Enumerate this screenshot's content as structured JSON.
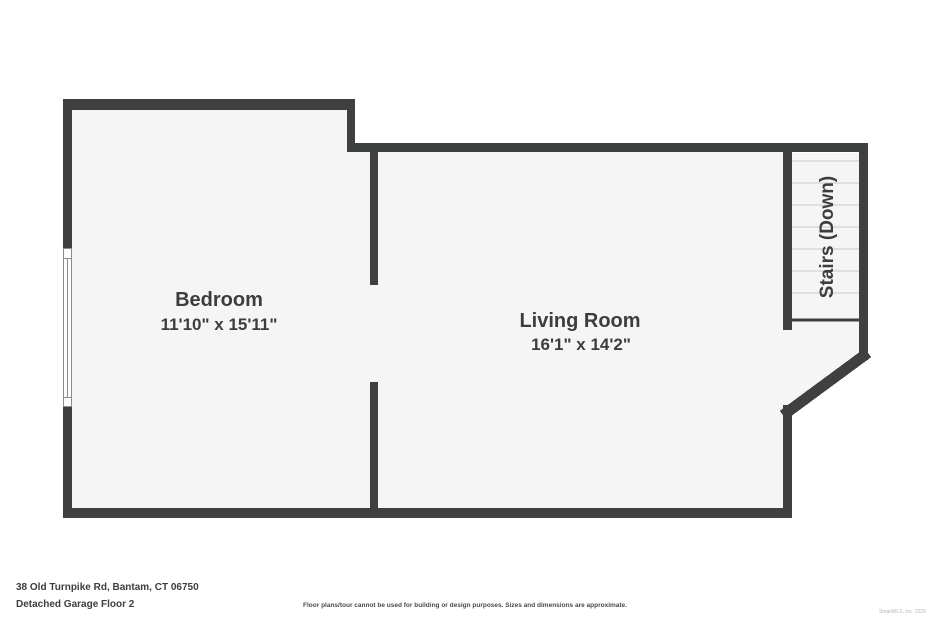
{
  "plan": {
    "rooms": {
      "bedroom": {
        "name": "Bedroom",
        "dimensions": "11'10\" x 15'11\""
      },
      "living_room": {
        "name": "Living Room",
        "dimensions": "16'1\" x 14'2\""
      },
      "stairs": {
        "label": "Stairs (Down)"
      }
    }
  },
  "footer": {
    "address": "38 Old Turnpike Rd, Bantam, CT 06750",
    "floor": "Detached Garage Floor 2",
    "disclaimer": "Floor plans/tour cannot be used for building or design purposes. Sizes and dimensions are approximate.",
    "watermark": "SmartMLS, Inc. 2025"
  },
  "colors": {
    "wall": "#3f4040",
    "room_fill": "#f5f5f5",
    "step_line": "#c9c9c9",
    "text": "#3d3d3d"
  }
}
